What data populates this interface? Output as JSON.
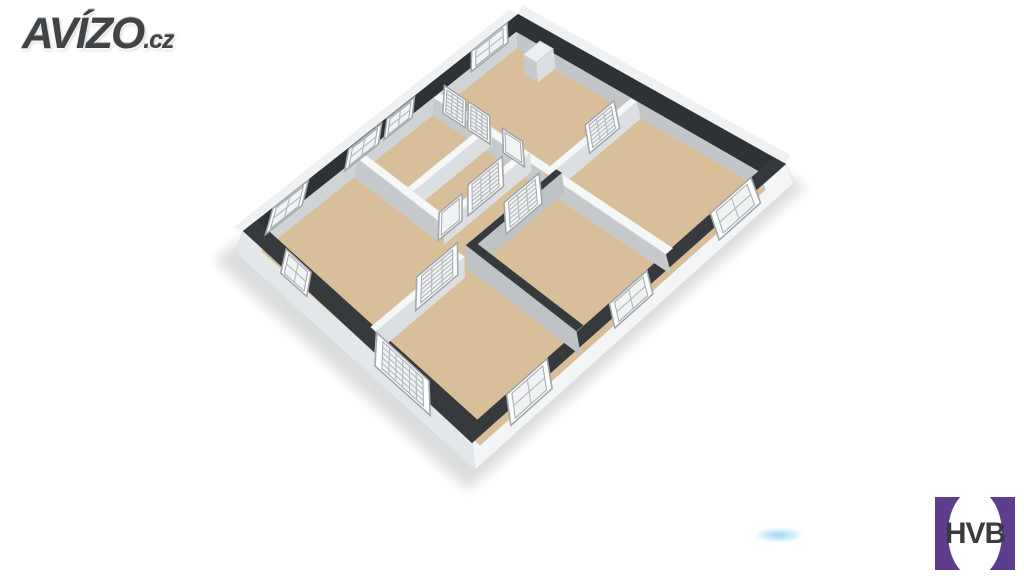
{
  "watermark": {
    "text": "AVÍZO",
    "suffix": ".cz"
  },
  "partner": {
    "text": "HVB",
    "square_color": "#5f3d8e",
    "text_color": "#3b3b3d"
  },
  "smudge_color": "#5abeeb",
  "floorplan": {
    "cap_quad": [
      [
        518,
        14
      ],
      [
        786,
        164
      ],
      [
        472,
        443
      ],
      [
        243,
        231
      ]
    ],
    "floor_quad": [
      [
        519,
        30
      ],
      [
        794,
        183
      ],
      [
        475,
        470
      ],
      [
        236,
        253
      ]
    ],
    "wall_t": 0.022,
    "outer": {
      "ne_v": 0.05,
      "nw_u": 0.045,
      "se_u": 0.955,
      "sw_v": 0.95
    },
    "colors": {
      "cap_dark": "#2e3235",
      "cap_dark2": "#363a3d",
      "wall_cap": "#f6f7f7",
      "face_u": "#dcdfe1",
      "face_v": "#c6cacc",
      "face_dark": "#bfc3c5",
      "inner_ne": "#c2c6c8",
      "inner_nw": "#d1d4d6",
      "ext_se": "#f3f5f6",
      "ext_sw": "#e4e7e9",
      "ext_far": "#eff1f2",
      "floor": "#d8bf9a",
      "frame_fill": "#fdfdfd",
      "frame_stroke": "#a3a8ab",
      "pane_fill": "#f0f2f3",
      "pane_stroke": "#b4b9bb",
      "block_cap": "#eceeef",
      "shadow": "#a9adaf"
    },
    "walls": [
      {
        "axis": "u",
        "pos": 0.325,
        "from": 0.045,
        "to": 0.475,
        "cap": "white"
      },
      {
        "axis": "v",
        "pos": 0.475,
        "from": 0.05,
        "to": 0.347,
        "cap": "white"
      },
      {
        "axis": "u",
        "pos": 0.325,
        "from": 0.497,
        "to": 0.955,
        "cap": "white"
      },
      {
        "axis": "v",
        "pos": 0.225,
        "from": 0.325,
        "to": 0.6,
        "cap": "white"
      },
      {
        "axis": "v",
        "pos": 0.375,
        "from": 0.325,
        "to": 0.62,
        "cap": "white"
      },
      {
        "axis": "u",
        "pos": 0.6,
        "from": 0.045,
        "to": 0.375,
        "cap": "white"
      },
      {
        "axis": "v",
        "pos": 0.5,
        "from": 0.325,
        "to": 0.632,
        "cap": "dark"
      },
      {
        "axis": "u",
        "pos": 0.61,
        "from": 0.5,
        "to": 0.955,
        "cap": "dark"
      },
      {
        "axis": "v",
        "pos": 0.5,
        "from": 0.655,
        "to": 0.955,
        "cap": "white"
      }
    ],
    "blocks": [
      {
        "u1": 0.13,
        "u2": 0.18,
        "v1": 0.045,
        "v2": 0.105,
        "h": 1.15
      }
    ],
    "panels": [
      {
        "k": "win",
        "a": [
          0.022,
          0.06
        ],
        "b": [
          0.022,
          0.19
        ],
        "h1": 0.25,
        "h2": 1.45,
        "c": 2,
        "r": 2
      },
      {
        "k": "win",
        "a": [
          0.022,
          0.4
        ],
        "b": [
          0.022,
          0.5
        ],
        "h1": 0.3,
        "h2": 1.4,
        "c": 2,
        "r": 2
      },
      {
        "k": "win",
        "a": [
          0.022,
          0.52
        ],
        "b": [
          0.022,
          0.64
        ],
        "h1": 0.3,
        "h2": 1.4,
        "c": 2,
        "r": 2
      },
      {
        "k": "win",
        "a": [
          0.022,
          0.79
        ],
        "b": [
          0.022,
          0.92
        ],
        "h1": 0.25,
        "h2": 1.45,
        "c": 2,
        "r": 2
      },
      {
        "k": "win",
        "a": [
          0.978,
          0.085
        ],
        "b": [
          0.978,
          0.215
        ],
        "h1": 0.05,
        "h2": 1.35,
        "c": 2,
        "r": 2
      },
      {
        "k": "win",
        "a": [
          0.978,
          0.42
        ],
        "b": [
          0.978,
          0.54
        ],
        "h1": 0.25,
        "h2": 1.3,
        "c": 2,
        "r": 2
      },
      {
        "k": "win",
        "a": [
          0.978,
          0.74
        ],
        "b": [
          0.978,
          0.87
        ],
        "h1": 0.1,
        "h2": 1.3,
        "c": 2,
        "r": 2
      },
      {
        "k": "win",
        "a": [
          0.15,
          0.975
        ],
        "b": [
          0.26,
          0.975
        ],
        "h1": 0.3,
        "h2": 1.35,
        "c": 2,
        "r": 2
      },
      {
        "k": "grid",
        "a": [
          0.55,
          0.975
        ],
        "b": [
          0.78,
          0.975
        ],
        "h1": 0.0,
        "h2": 1.35,
        "c": 6,
        "r": 5
      },
      {
        "k": "grid",
        "a": [
          0.06,
          0.325
        ],
        "b": [
          0.145,
          0.325
        ],
        "h1": 0.0,
        "h2": 1.5,
        "c": 3,
        "r": 6
      },
      {
        "k": "grid",
        "a": [
          0.155,
          0.325
        ],
        "b": [
          0.24,
          0.325
        ],
        "h1": 0.0,
        "h2": 1.5,
        "c": 3,
        "r": 6
      },
      {
        "k": "grid",
        "a": [
          0.475,
          0.1
        ],
        "b": [
          0.475,
          0.2
        ],
        "h1": 0.0,
        "h2": 1.5,
        "c": 3,
        "r": 6
      },
      {
        "k": "grid",
        "a": [
          0.375,
          0.4
        ],
        "b": [
          0.375,
          0.52
        ],
        "h1": 0.0,
        "h2": 1.5,
        "c": 3,
        "r": 6
      },
      {
        "k": "grid",
        "a": [
          0.5,
          0.38
        ],
        "b": [
          0.5,
          0.5
        ],
        "h1": 0.0,
        "h2": 1.5,
        "c": 3,
        "r": 6
      },
      {
        "k": "grid",
        "a": [
          0.5,
          0.66
        ],
        "b": [
          0.5,
          0.8
        ],
        "h1": 0.0,
        "h2": 1.45,
        "c": 3,
        "r": 6
      },
      {
        "k": "door",
        "a": [
          0.29,
          0.325
        ],
        "b": [
          0.37,
          0.325
        ],
        "h1": 0.0,
        "h2": 1.3,
        "c": 1,
        "r": 1
      },
      {
        "k": "door",
        "a": [
          0.375,
          0.54
        ],
        "b": [
          0.375,
          0.62
        ],
        "h1": 0.0,
        "h2": 1.3,
        "c": 1,
        "r": 1
      }
    ]
  }
}
